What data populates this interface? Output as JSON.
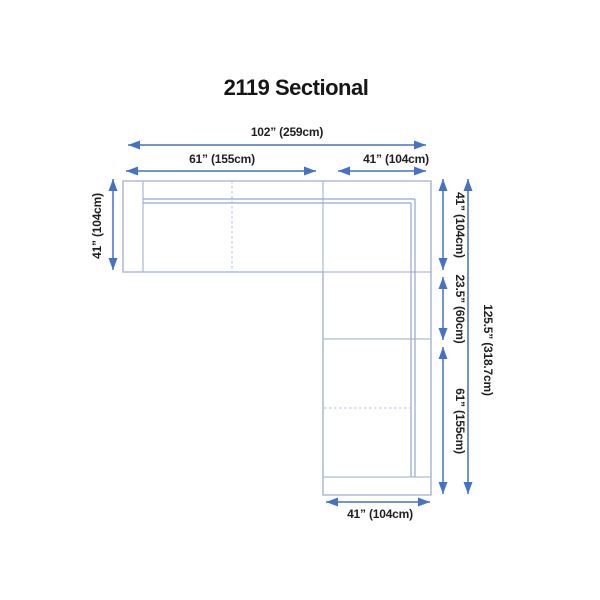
{
  "title": "2119 Sectional",
  "colors": {
    "dimension_blue": "#4472c4",
    "sofa_outline_blue": "#aebcd9",
    "backrest_line_blue": "#93a7cf",
    "label_text": "#1f1f1f",
    "background": "#ffffff"
  },
  "dimensions": {
    "top_total": "102” (259cm)",
    "top_left": "61” (155cm)",
    "top_right": "41” (104cm)",
    "left_side": "41” (104cm)",
    "right_upper": "41” (104cm)",
    "right_middle": "23.5” (60cm)",
    "right_lower": "61” (155cm)",
    "right_total": "125.5” (318.7cm)",
    "bottom": "41” (104cm)"
  }
}
